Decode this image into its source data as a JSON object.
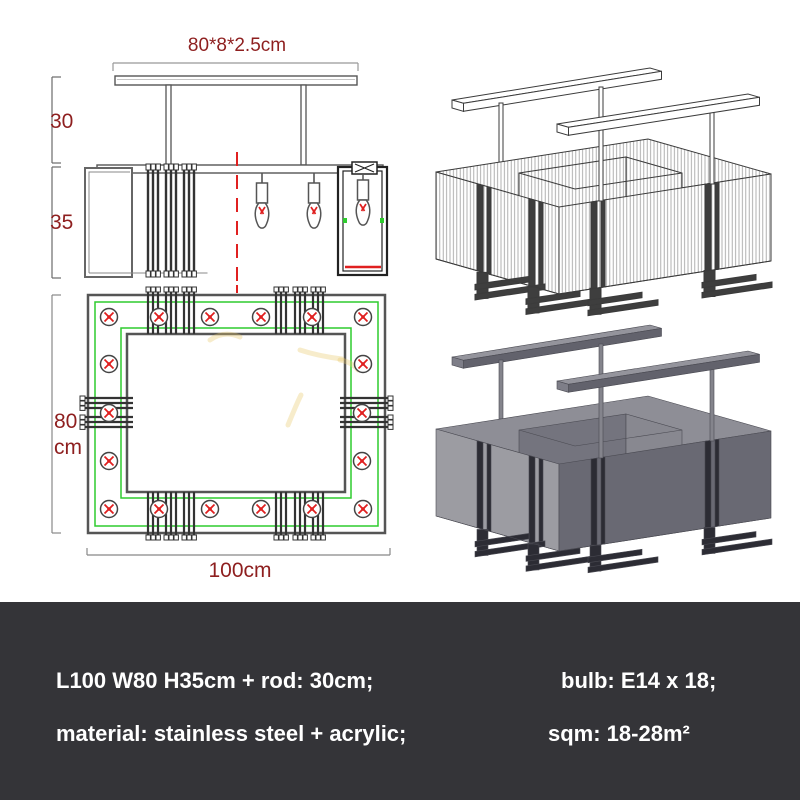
{
  "title": "chandelier-spec-sheet",
  "front_view": {
    "plate_dimension": "80*8*2.5cm",
    "rod_length": "30",
    "body_height": "35"
  },
  "top_view": {
    "width_value": "80",
    "width_unit": "cm",
    "length": "100cm",
    "bulb_count": 18
  },
  "specs": {
    "size": "L100 W80 H35cm + rod: 30cm;",
    "bulb": "bulb: E14 x 18;",
    "material": "material: stainless steel + acrylic;",
    "area": "sqm: 18-28m²"
  },
  "colors": {
    "dimension_text": "#8e1f1f",
    "banner_background": "#343438",
    "banner_text": "#ffffff",
    "accent_green": "#2ecc2e",
    "accent_red": "#e02020",
    "drawing_line": "#3b3b3b",
    "render_gray_light": "#9c9ca2",
    "render_gray_dark": "#696973"
  }
}
